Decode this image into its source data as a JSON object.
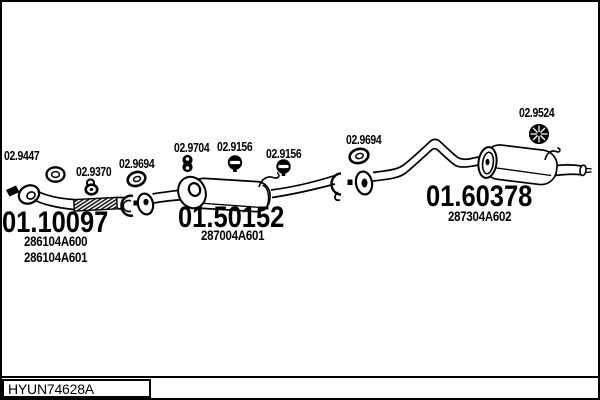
{
  "diagram": {
    "drawing_code": "HYUN74628A",
    "colors": {
      "line": "#000000",
      "background": "#ffffff"
    },
    "main_parts": [
      {
        "ref": "01.10097",
        "component": "front-exhaust-pipe",
        "oem_numbers": [
          "286104A600",
          "286104A601"
        ]
      },
      {
        "ref": "01.50152",
        "component": "middle-silencer",
        "oem_numbers": [
          "287004A601"
        ]
      },
      {
        "ref": "01.60378",
        "component": "rear-silencer",
        "oem_numbers": [
          "287304A602"
        ]
      }
    ],
    "fittings": [
      {
        "ref": "02.9447",
        "icon": "gasket-ring-icon"
      },
      {
        "ref": "02.9370",
        "icon": "rubber-hanger-icon"
      },
      {
        "ref": "02.9694",
        "icon": "rubber-grommet-icon"
      },
      {
        "ref": "02.9704",
        "icon": "double-hole-hanger-icon"
      },
      {
        "ref": "02.9156",
        "icon": "bolt-mount-icon"
      },
      {
        "ref": "02.9156",
        "icon": "bolt-mount-icon"
      },
      {
        "ref": "02.9694",
        "icon": "rubber-grommet-icon"
      },
      {
        "ref": "02.9524",
        "icon": "mesh-grommet-icon"
      }
    ]
  }
}
